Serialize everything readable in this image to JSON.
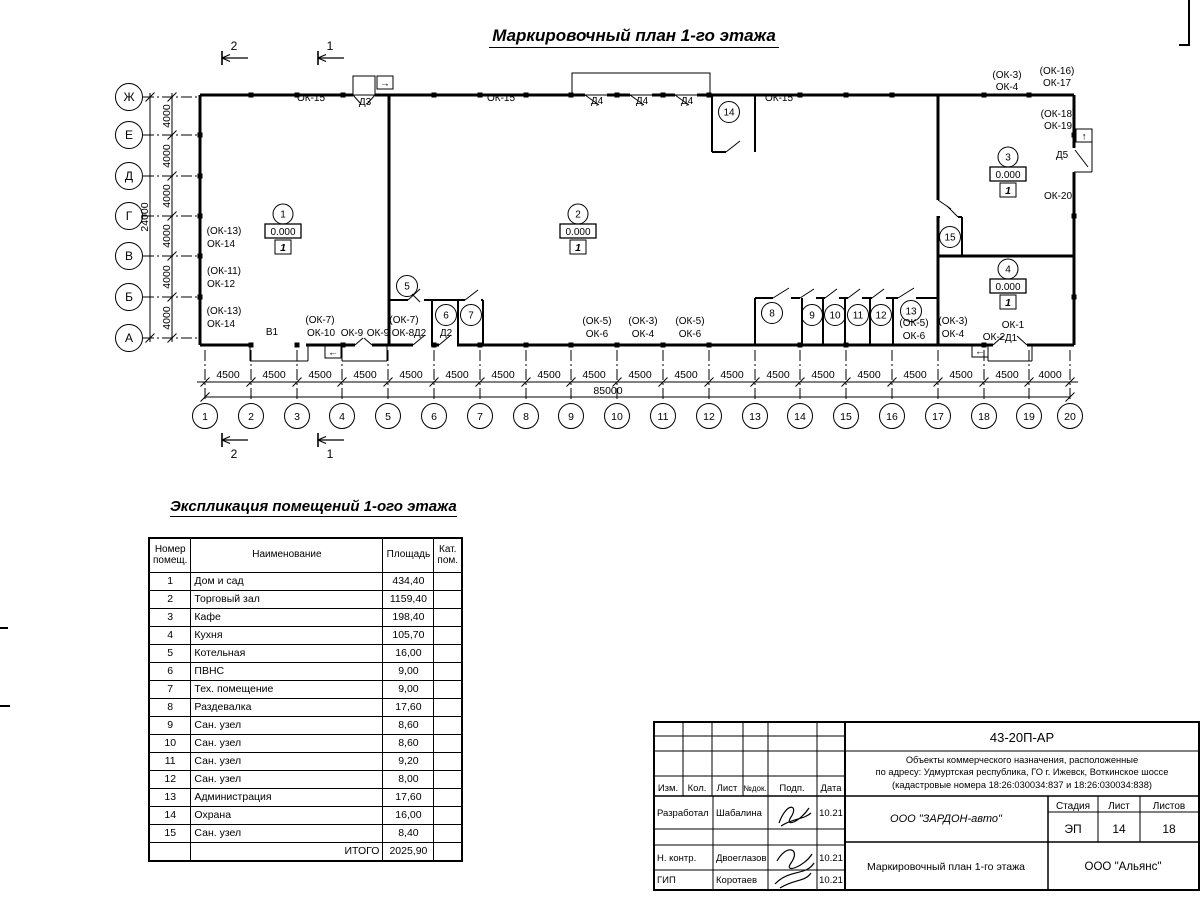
{
  "title": "Маркировочный план 1-го этажа",
  "plan": {
    "letter_axes": [
      {
        "label": "Ж",
        "y": 97
      },
      {
        "label": "Е",
        "y": 135
      },
      {
        "label": "Д",
        "y": 176
      },
      {
        "label": "Г",
        "y": 216
      },
      {
        "label": "В",
        "y": 256
      },
      {
        "label": "Б",
        "y": 297
      },
      {
        "label": "А",
        "y": 338
      }
    ],
    "number_axes": [
      {
        "label": "1",
        "x": 205
      },
      {
        "label": "2",
        "x": 251
      },
      {
        "label": "3",
        "x": 297
      },
      {
        "label": "4",
        "x": 342
      },
      {
        "label": "5",
        "x": 388
      },
      {
        "label": "6",
        "x": 434
      },
      {
        "label": "7",
        "x": 480
      },
      {
        "label": "8",
        "x": 526
      },
      {
        "label": "9",
        "x": 571
      },
      {
        "label": "10",
        "x": 617
      },
      {
        "label": "11",
        "x": 663
      },
      {
        "label": "12",
        "x": 709
      },
      {
        "label": "13",
        "x": 755
      },
      {
        "label": "14",
        "x": 800
      },
      {
        "label": "15",
        "x": 846
      },
      {
        "label": "16",
        "x": 892
      },
      {
        "label": "17",
        "x": 938
      },
      {
        "label": "18",
        "x": 984
      },
      {
        "label": "19",
        "x": 1029
      },
      {
        "label": "20",
        "x": 1070
      }
    ],
    "bay_dims": [
      {
        "t": "4500",
        "x": 228
      },
      {
        "t": "4500",
        "x": 274
      },
      {
        "t": "4500",
        "x": 320
      },
      {
        "t": "4500",
        "x": 365
      },
      {
        "t": "4500",
        "x": 411
      },
      {
        "t": "4500",
        "x": 457
      },
      {
        "t": "4500",
        "x": 503
      },
      {
        "t": "4500",
        "x": 549
      },
      {
        "t": "4500",
        "x": 594
      },
      {
        "t": "4500",
        "x": 640
      },
      {
        "t": "4500",
        "x": 686
      },
      {
        "t": "4500",
        "x": 732
      },
      {
        "t": "4500",
        "x": 778
      },
      {
        "t": "4500",
        "x": 823
      },
      {
        "t": "4500",
        "x": 869
      },
      {
        "t": "4500",
        "x": 915
      },
      {
        "t": "4500",
        "x": 961
      },
      {
        "t": "4500",
        "x": 1007
      },
      {
        "t": "4000",
        "x": 1050
      }
    ],
    "total_dim": "85000",
    "v_dims": [
      {
        "t": "4000",
        "y": 116
      },
      {
        "t": "4000",
        "y": 156
      },
      {
        "t": "4000",
        "y": 196
      },
      {
        "t": "4000",
        "y": 236
      },
      {
        "t": "4000",
        "y": 277
      },
      {
        "t": "4000",
        "y": 318
      }
    ],
    "v_total_dim": "24000",
    "labels": [
      {
        "t": "ОК-15",
        "x": 311,
        "y": 101
      },
      {
        "t": "Д3",
        "x": 365,
        "y": 105
      },
      {
        "t": "ОК-15",
        "x": 501,
        "y": 101
      },
      {
        "t": "Д4",
        "x": 597,
        "y": 104
      },
      {
        "t": "Д4",
        "x": 642,
        "y": 104
      },
      {
        "t": "Д4",
        "x": 687,
        "y": 104
      },
      {
        "t": "ОК-15",
        "x": 779,
        "y": 101
      },
      {
        "t": "(ОК-3)",
        "x": 1007,
        "y": 78
      },
      {
        "t": "ОК-4",
        "x": 1007,
        "y": 90
      },
      {
        "t": "(ОК-16)",
        "x": 1057,
        "y": 74
      },
      {
        "t": "ОК-17",
        "x": 1057,
        "y": 86
      },
      {
        "t": "(ОК-18)",
        "x": 1058,
        "y": 117
      },
      {
        "t": "ОК-19",
        "x": 1058,
        "y": 129
      },
      {
        "t": "Д5",
        "x": 1062,
        "y": 158
      },
      {
        "t": "ОК-20",
        "x": 1058,
        "y": 199
      },
      {
        "t": "(ОК-13)",
        "x": 224,
        "y": 234
      },
      {
        "t": "ОК-14",
        "x": 221,
        "y": 247
      },
      {
        "t": "(ОК-11)",
        "x": 224,
        "y": 274
      },
      {
        "t": "ОК-12",
        "x": 221,
        "y": 287
      },
      {
        "t": "(ОК-13)",
        "x": 224,
        "y": 314
      },
      {
        "t": "ОК-14",
        "x": 221,
        "y": 327
      },
      {
        "t": "В1",
        "x": 272,
        "y": 335
      },
      {
        "t": "(ОК-7)",
        "x": 320,
        "y": 323
      },
      {
        "t": "ОК-10",
        "x": 321,
        "y": 336
      },
      {
        "t": "ОК-9",
        "x": 352,
        "y": 336
      },
      {
        "t": "ОК-9",
        "x": 378,
        "y": 336
      },
      {
        "t": "(ОК-7)",
        "x": 404,
        "y": 323
      },
      {
        "t": "ОК-8",
        "x": 403,
        "y": 336
      },
      {
        "t": "Д2",
        "x": 420,
        "y": 336
      },
      {
        "t": "Д2",
        "x": 446,
        "y": 336
      },
      {
        "t": "(ОК-5)",
        "x": 597,
        "y": 324
      },
      {
        "t": "ОК-6",
        "x": 597,
        "y": 337
      },
      {
        "t": "(ОК-3)",
        "x": 643,
        "y": 324
      },
      {
        "t": "ОК-4",
        "x": 643,
        "y": 337
      },
      {
        "t": "(ОК-5)",
        "x": 690,
        "y": 324
      },
      {
        "t": "ОК-6",
        "x": 690,
        "y": 337
      },
      {
        "t": "(ОК-5)",
        "x": 914,
        "y": 326
      },
      {
        "t": "ОК-6",
        "x": 914,
        "y": 339
      },
      {
        "t": "(ОК-3)",
        "x": 953,
        "y": 324
      },
      {
        "t": "ОК-4",
        "x": 953,
        "y": 337
      },
      {
        "t": "ОК-2",
        "x": 994,
        "y": 340
      },
      {
        "t": "ОК-1",
        "x": 1013,
        "y": 328
      },
      {
        "t": "Д1",
        "x": 1011,
        "y": 341
      }
    ],
    "rooms": [
      {
        "n": "5",
        "x": 407,
        "y": 286
      },
      {
        "n": "6",
        "x": 446,
        "y": 315
      },
      {
        "n": "7",
        "x": 471,
        "y": 315
      },
      {
        "n": "8",
        "x": 772,
        "y": 313
      },
      {
        "n": "9",
        "x": 812,
        "y": 315
      },
      {
        "n": "10",
        "x": 835,
        "y": 315
      },
      {
        "n": "11",
        "x": 858,
        "y": 315
      },
      {
        "n": "12",
        "x": 881,
        "y": 315
      },
      {
        "n": "13",
        "x": 911,
        "y": 311
      },
      {
        "n": "14",
        "x": 729,
        "y": 112
      },
      {
        "n": "15",
        "x": 950,
        "y": 237
      }
    ],
    "room_markers": [
      {
        "n": "1",
        "x": 283,
        "y": 214,
        "elevation": "0.000",
        "floor": "1"
      },
      {
        "n": "2",
        "x": 578,
        "y": 214,
        "elevation": "0.000",
        "floor": "1"
      },
      {
        "n": "3",
        "x": 1008,
        "y": 157,
        "elevation": "0.000",
        "floor": "1"
      },
      {
        "n": "4",
        "x": 1008,
        "y": 269,
        "elevation": "0.000",
        "floor": "1"
      }
    ],
    "exit_arrows": [
      {
        "glyph": "→",
        "x": 385,
        "y": 83
      },
      {
        "glyph": "←",
        "x": 333,
        "y": 352
      },
      {
        "glyph": "←",
        "x": 980,
        "y": 351
      },
      {
        "glyph": "↑",
        "x": 1084,
        "y": 136
      }
    ],
    "section_marks": [
      {
        "l": "2",
        "x": 222,
        "y": 58,
        "ly": 50
      },
      {
        "l": "1",
        "x": 318,
        "y": 58,
        "ly": 50
      },
      {
        "l": "2",
        "x": 222,
        "y": 440,
        "ly": 458
      },
      {
        "l": "1",
        "x": 318,
        "y": 440,
        "ly": 458
      }
    ]
  },
  "explication": {
    "title": "Экспликация помещений 1-ого этажа",
    "headers": [
      "Номер помещ.",
      "Наименование",
      "Площадь",
      "Кат. пом."
    ],
    "rows": [
      [
        "1",
        "Дом и сад",
        "434,40"
      ],
      [
        "2",
        "Торговый зал",
        "1159,40"
      ],
      [
        "3",
        "Кафе",
        "198,40"
      ],
      [
        "4",
        "Кухня",
        "105,70"
      ],
      [
        "5",
        "Котельная",
        "16,00"
      ],
      [
        "6",
        "ПВНС",
        "9,00"
      ],
      [
        "7",
        "Тех. помещение",
        "9,00"
      ],
      [
        "8",
        "Раздевалка",
        "17,60"
      ],
      [
        "9",
        "Сан. узел",
        "8,60"
      ],
      [
        "10",
        "Сан. узел",
        "8,60"
      ],
      [
        "11",
        "Сан. узел",
        "9,20"
      ],
      [
        "12",
        "Сан. узел",
        "8,00"
      ],
      [
        "13",
        "Администрация",
        "17,60"
      ],
      [
        "14",
        "Охрана",
        "16,00"
      ],
      [
        "15",
        "Сан. узел",
        "8,40"
      ]
    ],
    "total_label": "ИТОГО",
    "total_value": "2025,90"
  },
  "title_block": {
    "doc_number": "43-20П-АР",
    "project_lines": [
      "Объекты коммерческого назначения, расположенные",
      "по адресу: Удмуртская республика, ГО г. Ижевск, Воткинское шоссе",
      "(кадастровые номера 18:26:030034:837 и 18:26:030034:838)"
    ],
    "header_cells": [
      "Изм.",
      "Кол.",
      "Лист",
      "№док.",
      "Подп.",
      "Дата"
    ],
    "roles": [
      {
        "role": "Разработал",
        "name": "Шабалина",
        "date": "10.21"
      },
      {
        "role": "Н. контр.",
        "name": "Двоеглазов",
        "date": "10.21"
      },
      {
        "role": "ГИП",
        "name": "Коротаев",
        "date": "10.21"
      }
    ],
    "company": "ООО \"ЗАРДОН-авто\"",
    "stage_label": "Стадия",
    "sheet_label": "Лист",
    "sheets_label": "Листов",
    "stage": "ЭП",
    "sheet": "14",
    "sheets": "18",
    "drawing_title": "Маркировочный план 1-го этажа",
    "contractor": "ООО \"Альянс\""
  }
}
